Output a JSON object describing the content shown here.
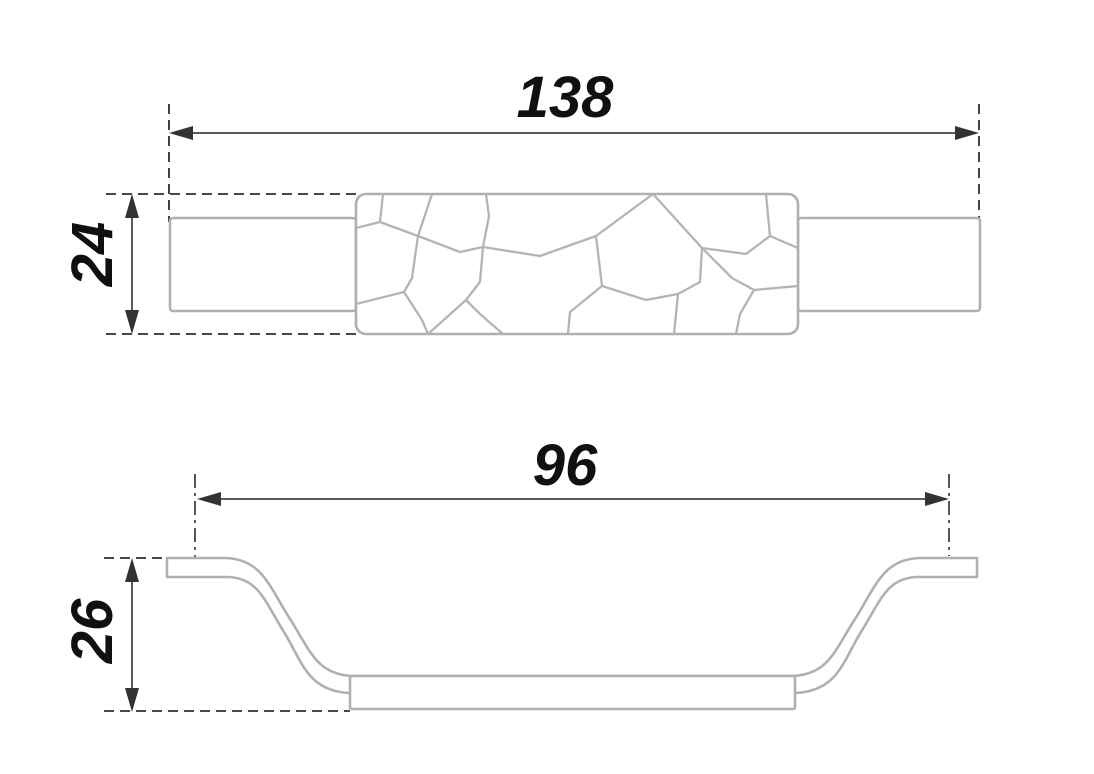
{
  "drawing": {
    "type": "furniture-handle-dimension-drawing",
    "views": {
      "top": {
        "label": "top-view",
        "dim_length": "138",
        "dim_height": "24"
      },
      "side": {
        "label": "side-profile-view",
        "dim_hole_spacing": "96",
        "dim_height": "26"
      }
    }
  },
  "colors": {
    "background": "#ffffff",
    "part_outline": "#b0b0b0",
    "dimension_line": "#5a5a5a",
    "arrow": "#333333",
    "extension_line": "#2e2e2e",
    "text": "#101010"
  }
}
